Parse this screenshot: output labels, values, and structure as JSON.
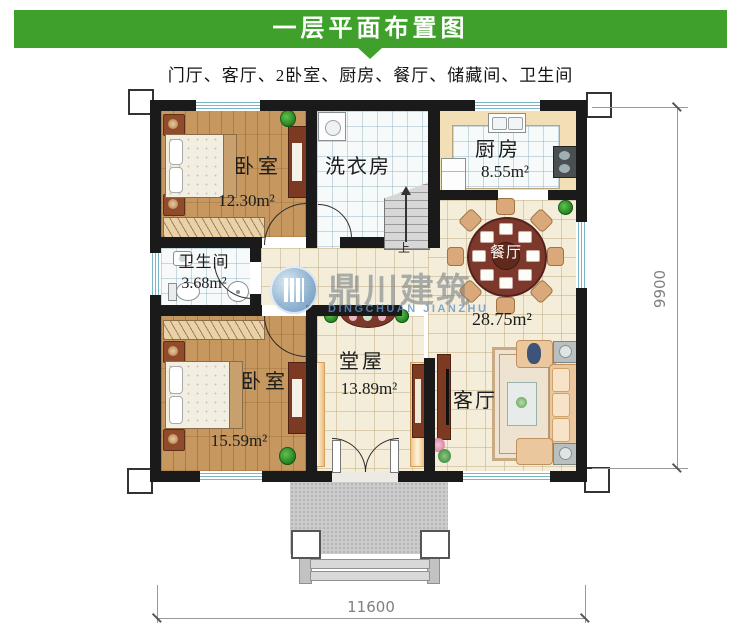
{
  "header": {
    "title": "一层平面布置图",
    "subtitle": "门厅、客厅、2卧室、厨房、餐厅、储藏间、卫生间"
  },
  "rooms": {
    "bedroom_top": {
      "name": "卧室",
      "area": "12.30m²"
    },
    "laundry": {
      "name": "洗衣房"
    },
    "kitchen": {
      "name": "厨房",
      "area": "8.55m²"
    },
    "bathroom": {
      "name": "卫生间",
      "area": "3.68m²"
    },
    "bedroom_bottom": {
      "name": "卧室",
      "area": "15.59m²"
    },
    "hall": {
      "name": "堂屋",
      "area": "13.89m²"
    },
    "dining": {
      "name": "餐厅"
    },
    "living": {
      "name": "客厅",
      "area": "28.75m²"
    }
  },
  "stairs": {
    "up_label": "上"
  },
  "dimensions": {
    "width_mm": "11600",
    "height_mm": "9900"
  },
  "watermark": {
    "company": "鼎川建筑",
    "latin": "DINGCHUAN JIANZHU"
  },
  "colors": {
    "banner_green": "#3fa12b",
    "wall_black": "#1a1a1a",
    "wood_floor": "#c6985f",
    "cream_tile": "#f4edda",
    "window_teal": "#79b8c2",
    "dining_table": "#7c382b"
  }
}
